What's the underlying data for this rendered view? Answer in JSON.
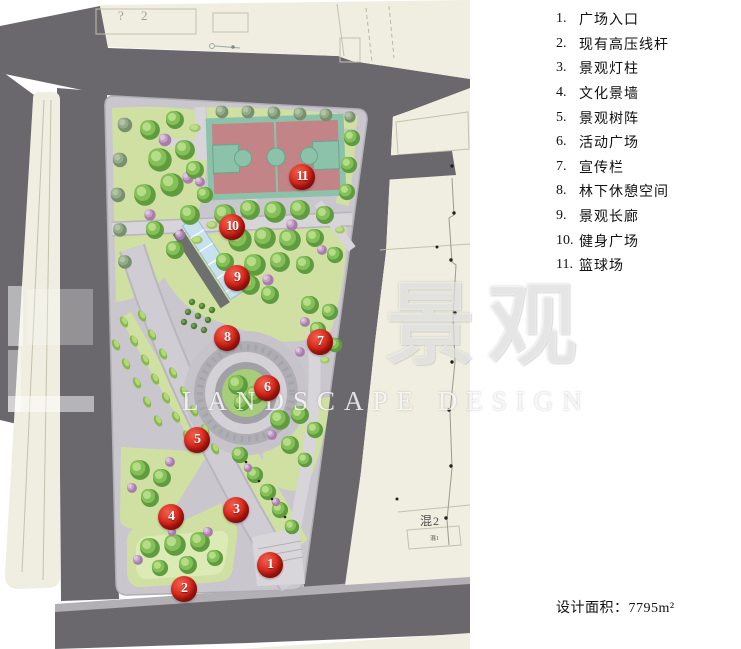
{
  "legend": {
    "items": [
      {
        "num": "1.",
        "label": "广场入口"
      },
      {
        "num": "2.",
        "label": "现有高压线杆"
      },
      {
        "num": "3.",
        "label": "景观灯柱"
      },
      {
        "num": "4.",
        "label": "文化景墙"
      },
      {
        "num": "5.",
        "label": "景观树阵"
      },
      {
        "num": "6.",
        "label": "活动广场"
      },
      {
        "num": "7.",
        "label": "宣传栏"
      },
      {
        "num": "8.",
        "label": "林下休憩空间"
      },
      {
        "num": "9.",
        "label": "景观长廊"
      },
      {
        "num": "10.",
        "label": "健身广场"
      },
      {
        "num": "11.",
        "label": "篮球场"
      }
    ]
  },
  "area": {
    "label": "设计面积：",
    "value": "7795m²"
  },
  "markers": [
    {
      "n": "1"
    },
    {
      "n": "2"
    },
    {
      "n": "3"
    },
    {
      "n": "4"
    },
    {
      "n": "5"
    },
    {
      "n": "6"
    },
    {
      "n": "7"
    },
    {
      "n": "8"
    },
    {
      "n": "9"
    },
    {
      "n": "10"
    },
    {
      "n": "11"
    }
  ],
  "map_labels": {
    "block_top": "? 2",
    "block_right_main": "混2",
    "block_right_sub": "混1"
  },
  "watermark": {
    "cn": "景观",
    "en": "LANDSCAPE DESIGN"
  },
  "colors": {
    "road": "#6b686d",
    "block_beige": "#efeee0",
    "park_pavement": "#c9c7cd",
    "lawn": "#cfe0a2",
    "court_red": "#c28486",
    "court_teal": "#8cc2a9",
    "corridor_blue": "#c7e1ef",
    "marker_red": "#da2c1f"
  }
}
